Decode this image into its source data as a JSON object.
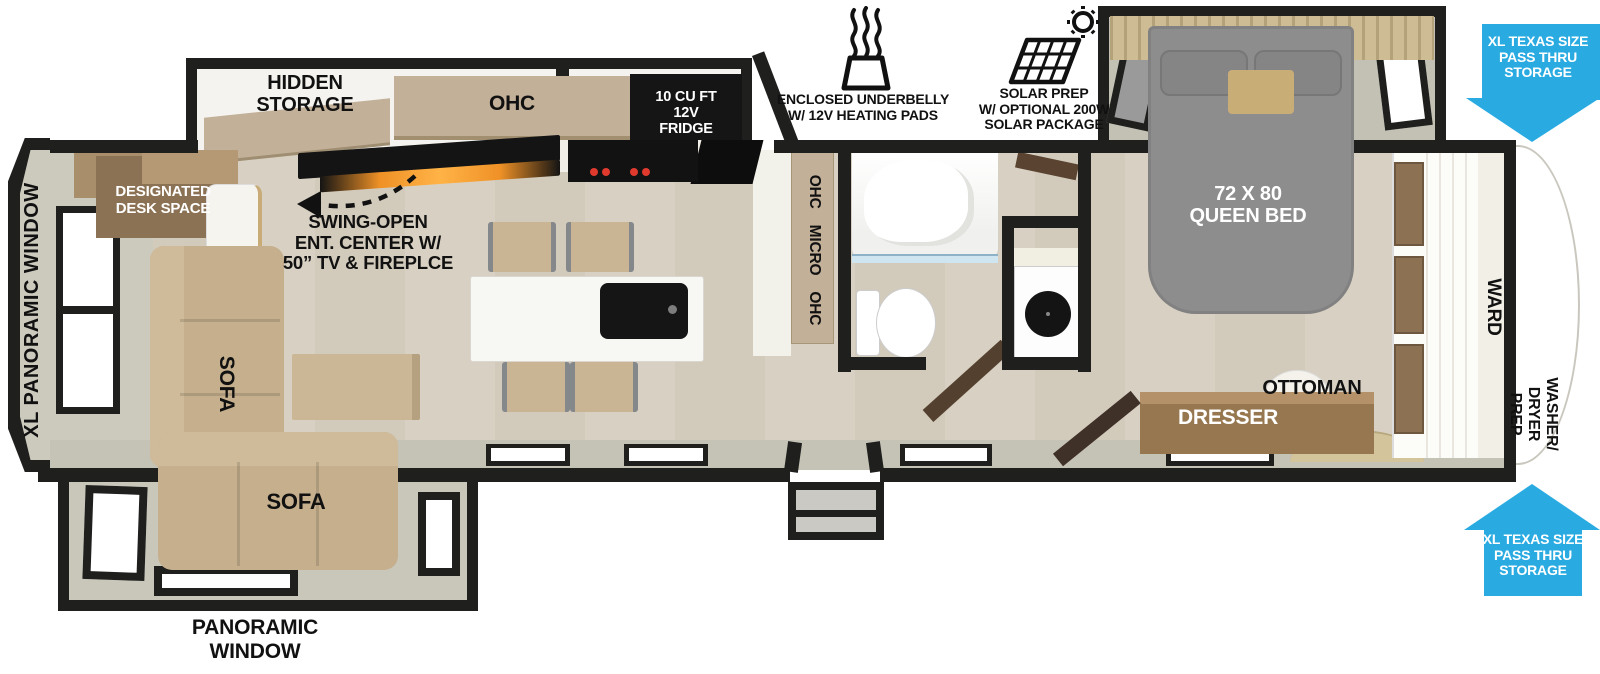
{
  "colors": {
    "wall": "#1f1f1d",
    "floor-wood": "#d8d1c3",
    "floor-wood2": "#d2cabb",
    "slide-gray": "#c9c6ba",
    "band-gray": "#c5c2b6",
    "cabinet-tan": "#c2b098",
    "wood-brown": "#8d7153",
    "sofa-tan": "#c5af8d",
    "bed-gray": "#8d8d8d",
    "arrow-blue": "#29abe2",
    "appliance-black": "#151515",
    "burner-red": "#e03a2f",
    "flame-orange": "#ef9126",
    "white-floor": "#f4f3ef"
  },
  "exterior": {
    "underbelly_label": "ENCLOSED UNDERBELLY\nW/ 12V HEATING PADS",
    "solar_label": "SOLAR PREP\nW/ OPTIONAL 200W\nSOLAR PACKAGE",
    "pass_thru_label": "XL TEXAS SIZE\nPASS THRU\nSTORAGE",
    "panoramic_window": "PANORAMIC\nWINDOW",
    "xl_panoramic_window": "XL PANORAMIC WINDOW"
  },
  "living": {
    "hidden_storage": "HIDDEN\nSTORAGE",
    "designated_desk": "DESIGNATED\nDESK SPACE",
    "ent_center": "SWING-OPEN\nENT. CENTER W/\n50” TV & FIREPLCE",
    "sofa": "SOFA"
  },
  "kitchen": {
    "ohc": "OHC",
    "fridge": "10 CU FT\n12V\nFRIDGE",
    "ohc_micro_ohc": "OHC MICRO OHC"
  },
  "bedroom": {
    "queen_bed": "72 X 80\nQUEEN BED",
    "ottoman": "OTTOMAN",
    "dresser": "DRESSER",
    "ward": "WARD",
    "washer_dryer_prep": "WASHER/\nDRYER\nPREP"
  }
}
